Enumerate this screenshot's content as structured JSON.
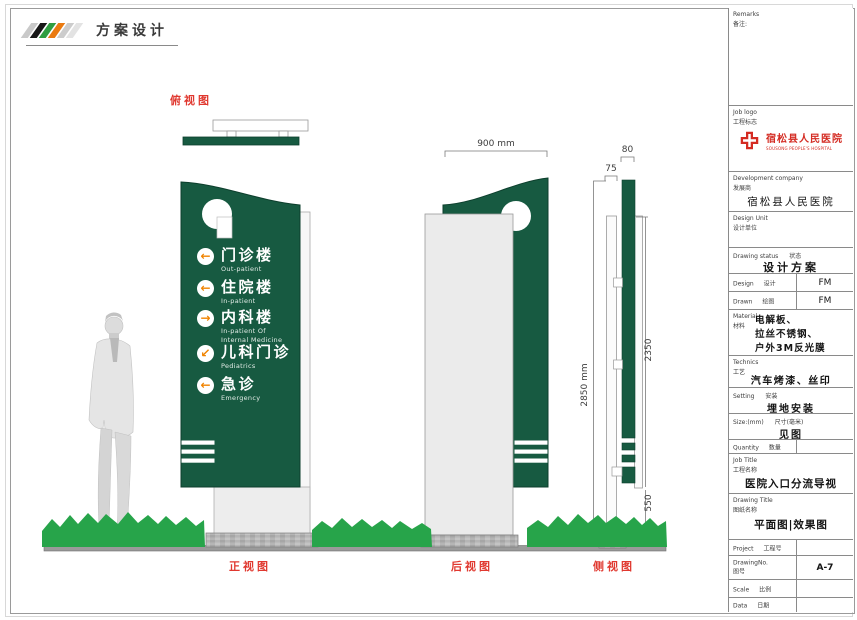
{
  "brand": {
    "title": "方案设计",
    "stripe_colors": [
      "#c9c9c9",
      "#171717",
      "#2f9e41",
      "#ea7a10",
      "#cccccc",
      "#e3e3e3"
    ]
  },
  "view_labels": {
    "top": "俯视图",
    "front": "正视图",
    "back": "后视图",
    "side": "侧视图"
  },
  "sign": {
    "items": [
      {
        "zh": "门诊楼",
        "en": "Out-patient",
        "arrow": "left",
        "arrow_glyph": "←"
      },
      {
        "zh": "住院楼",
        "en": "In-patient",
        "arrow": "left",
        "arrow_glyph": "←"
      },
      {
        "zh": "内科楼",
        "en": "In-patient Of\nInternal Medicine",
        "arrow": "right",
        "arrow_glyph": "→"
      },
      {
        "zh": "儿科门诊",
        "en": "Pediatrics",
        "arrow": "down-left",
        "arrow_glyph": "↙"
      },
      {
        "zh": "急诊",
        "en": "Emergency",
        "arrow": "left",
        "arrow_glyph": "←"
      }
    ]
  },
  "dimensions": {
    "panel_width": "900 mm",
    "green_depth": "80",
    "pole_depth": "75",
    "total_height": "2850 mm",
    "panel_height": "2350",
    "base_height": "550"
  },
  "colors": {
    "sign_green": "#175A41",
    "grass_green": "#27A44A",
    "arrow_orange": "#F08300",
    "label_red": "#E0382F",
    "logo_red": "#D42B22"
  },
  "title_block": {
    "remarks": {
      "en": "Remarks",
      "zh": "备注:"
    },
    "job_logo": {
      "en": "Job logo",
      "zh": "工程标志",
      "logo_zh": "宿松县人民医院",
      "logo_en": "SOUSONG PEOPLE'S HOSPITAL"
    },
    "development_company": {
      "en": "Development company",
      "zh": "发展商",
      "value": "宿松县人民医院"
    },
    "design_unit": {
      "en": "Design Unit",
      "zh": "设计单位"
    },
    "drawing_status": {
      "en": "Drawing status",
      "zh": "状态",
      "value": "设计方案"
    },
    "design": {
      "en": "Design",
      "zh": "设计",
      "value": "FM"
    },
    "drawn": {
      "en": "Drawn",
      "zh": "绘图",
      "value": "FM"
    },
    "material": {
      "en": "Material",
      "zh": "材料",
      "value": "电解板、\n拉丝不锈钢、\n户外3M反光膜"
    },
    "technics": {
      "en": "Technics",
      "zh": "工艺",
      "value": "汽车烤漆、丝印"
    },
    "setting": {
      "en": "Setting",
      "zh": "安装",
      "value": "埋地安装"
    },
    "size": {
      "en": "Size:(mm)",
      "zh": "尺寸(毫米)",
      "value": "见图"
    },
    "quantity": {
      "en": "Quantity",
      "zh": "数量",
      "value": ""
    },
    "job_title": {
      "en": "Job Title",
      "zh": "工程名称",
      "value": "医院入口分流导视"
    },
    "drawing_title": {
      "en": "Drawing Title",
      "zh": "图纸名称",
      "value": "平面图|效果图"
    },
    "project": {
      "en": "Project",
      "zh": "工程号",
      "value": ""
    },
    "drawing_no": {
      "en": "DrawingNo.",
      "zh": "图号",
      "value": "A-7"
    },
    "scale": {
      "en": "Scale",
      "zh": "比例",
      "value": ""
    },
    "data": {
      "en": "Data",
      "zh": "日期",
      "value": ""
    }
  }
}
